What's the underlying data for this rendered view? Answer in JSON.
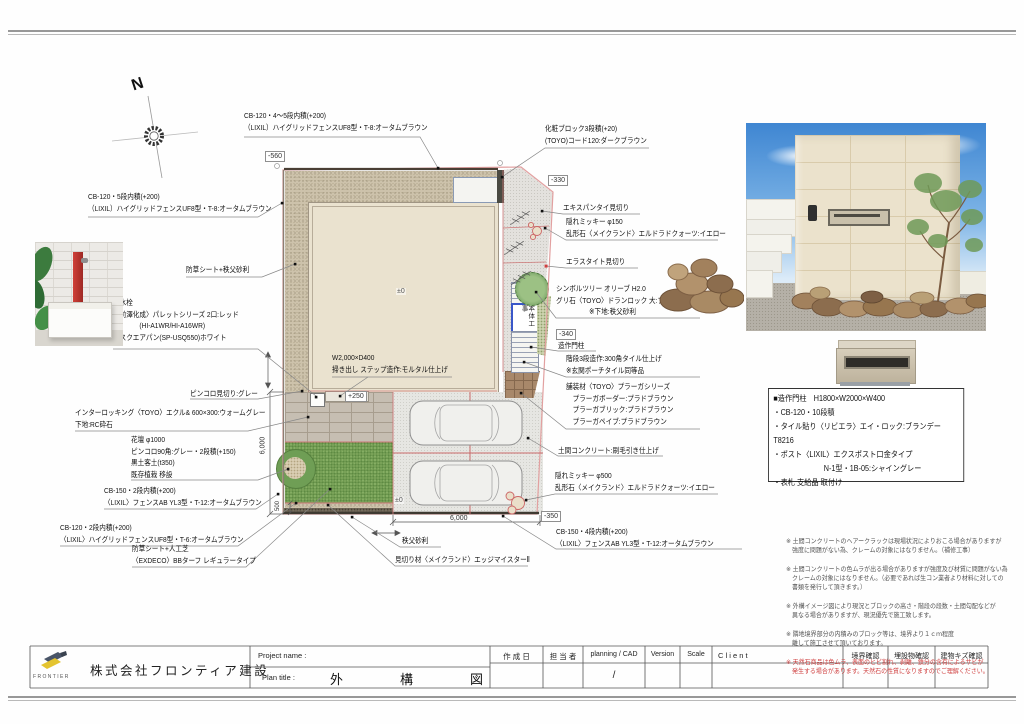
{
  "compass": {
    "north": "N"
  },
  "plan": {
    "levels": {
      "house": "±0",
      "parking": "±0"
    },
    "markers": {
      "top_left": "-560",
      "top_right": "-330",
      "entrance": "-340",
      "bottom_right": "-350",
      "step": "+250"
    },
    "dims": {
      "left_v": "6,000",
      "bottom_h": "6,000",
      "strip_v": "500"
    },
    "main_works_box": "本体工事"
  },
  "callouts": {
    "cb120_45": "CB-120・4～5段内積(+200)\n（LIXIL）ハイグリッドフェンスUF8型・T-8:オータムブラウン",
    "cb120_5": "CB-120・5段内積(+200)\n（LIXIL）ハイグリッドフェンスUF8型・T-8:オータムブラウン",
    "weed_sheet_gravel": "防草シート+秩父砂利",
    "standpipe": "立水栓\n〈前澤化成〉パレットシリーズ 2口:レッド\n　　　　(HI-A1WR/HI-A16WR)\n　スクエアパン(SP-USQ550)ホワイト",
    "pinkoro_edge": "ピンコロ見切り:グレー",
    "interlocking": "インターロッキング〈TOYO〉エクル& 600×300:ウォームグレー\n下地:RC砕石",
    "flower_bed": "花壇 φ1000\nピンコロ90角:グレー・2段積(+150)\n黒土客土(t350)\n既存植栽 移設",
    "cb150_2": "CB-150・2段内積(+200)\n〈LIXIL〉フェンスAB YL3型・T-12:オータムブラウン",
    "cb120_2": "CB-120・2段内積(+200)\n〈LIXIL〉ハイグリッドフェンスUF8型・T-6:オータムブラウン",
    "artificial_turf": "防草シート+人工芝\n〈EXDECO〉BBターフ レギュラータイプ",
    "edge_material": "見切り材〈メイクランド〉エッジマイスターⅡ",
    "chichibu_gravel": "秩父砂利",
    "step_work": "W2,000×D400\n掃き出し ステップ造作:モルタル仕上げ",
    "decor_block": "化粧ブロック3段積(+20)\n(TOYO)コード120:ダークブラウン",
    "expantay": "エキスパンタイ見切り",
    "mickey_150": "隠れミッキー φ150\n乱形石〈メイクランド〉エルドラドクォーツ:イエロー",
    "elastite": "エラスタイト見切り",
    "symbol_tree": "シンボルツリー オリーブ H2.0\nグリ石〈TOYO〉ドランロック 大:ブラウン\n　　　　　※下地:秩父砂利",
    "gate_post": "造作門柱",
    "stairs": "階段3段造作:300角タイル仕上げ\n※玄関ポーチタイル同等品",
    "paving": "舗装材〈TOYO〉プラーガシリーズ\n　プラーガボーダー:プラドブラウン\n　プラーガブリック:プラドブラウン\n　プラーガペイブ:プラドブラウン",
    "doma_concrete": "土間コンクリート:刷毛引き仕上げ",
    "mickey_500": "隠れミッキー φ500\n乱形石〈メイクランド〉エルドラドクォーツ:イエロー",
    "cb150_4": "CB-150・4段内積(+200)\n〈LIXIL〉フェンスAB YL3型・T-12:オータムブラウン"
  },
  "spec_box": {
    "text": "■造作門柱　H1800×W2000×W400\n・CB-120・10段積\n・タイル貼り〈リビエラ〉エイ・ロック:ブランデー T8216\n・ポスト〈LIXIL〉エクスポスト口金タイプ\n　　　　　　　N-1型・1B-05:シャイングレー\n・表札 支給品 取付け"
  },
  "notes": [
    {
      "text": "※ 土間コンクリートのヘアークラックは現場状況によりおこる場合がありますが\n　強度に問題がない為、クレームの対象にはなりません。（補修工事）"
    },
    {
      "text": "※ 土間コンクリートの色ムラが出る場合がありますが強度及び材質に問題がない為\n　クレームの対象にはなりません。（必要であれば生コン業者より材料に対しての\n　書類を発行して頂きます。）"
    },
    {
      "text": "※ 外構イメージ図により現況とブロックの高さ・階段の段数・土間勾配などが\n　異なる場合がありますが、現況優先で施工致します。"
    },
    {
      "text": "※ 隣地境界部分の内積みのブロック等は、境界より１ｃｍ程度\n　離して施工させて頂いております。"
    },
    {
      "text": "※ 天然石商品は色ムラ、表面のヒビ割れ、剥離、鉄分の含有によるサビが\n　発生する場合があります。天然石の性質になりますのでご理解ください。"
    }
  ],
  "titleblock": {
    "logo_text": "FRONTIER",
    "company": "株式会社フロンティア建設",
    "project_label": "Project name :",
    "plan_label": "Plan title :",
    "plan_title": "外　構　図",
    "col_date": "作 成 日",
    "col_person": "担 当 者",
    "col_planning": "planning / CAD",
    "col_version": "Version",
    "col_scale": "Scale",
    "col_client": "C l i e n t",
    "col_boundary": "境界確認",
    "col_buried": "埋設物確認",
    "col_scratch": "建物キズ確認",
    "planning_value": "/"
  }
}
